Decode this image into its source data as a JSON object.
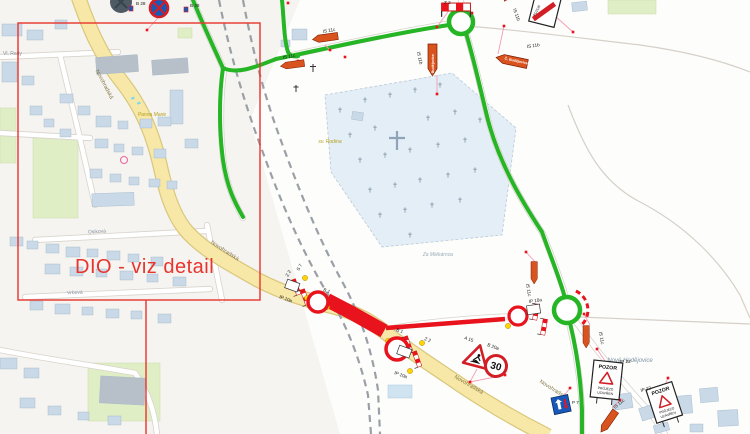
{
  "map": {
    "type": "traffic-detour-plan (DIO)",
    "detail_note": "DIO - viz detail",
    "street_labels": [
      "Novohradská",
      "Novohradská",
      "Novohradská",
      "Novohradská",
      "Osiková",
      "Vrbová",
      "Vl. Rady"
    ],
    "place_labels": [
      "Nové Hodějovice",
      "Za Mlékárnou",
      "sv. Rodina",
      "Panna Marie"
    ],
    "sign_labels": [
      "B 28",
      "B 28",
      "IS 11c",
      "IS 11c",
      "IS 11b",
      "IS 11b",
      "IS 11b",
      "Z 2",
      "S 7",
      "B 1",
      "IP 10a",
      "Z 2",
      "B 1",
      "IP 10a",
      "A 15",
      "B 20a",
      "IS 11c",
      "IS 11c",
      "IP 10a",
      "IP 22",
      "IP 22",
      "P 7",
      "IS 11c",
      "Z 2"
    ],
    "signs": {
      "speed_limit_value": "30",
      "detour_arrow_text": "Č. Budějovice",
      "pozor_board": {
        "title": "POZOR",
        "line1": "PRŮJEZD",
        "line2": "UZAVŘEN"
      }
    },
    "colors": {
      "detour_route": "#25b525",
      "closure": "#e8131d",
      "main_road": "#f8e8a8",
      "detail_frame": "#e8342c",
      "building": "#c9d9e7",
      "building_dark": "#b7c0c9",
      "cemetery": "#e3eef7",
      "sign_orange": "#d9531e",
      "sign_blue": "#1758b8",
      "lamp_yellow": "#ffd400"
    }
  }
}
